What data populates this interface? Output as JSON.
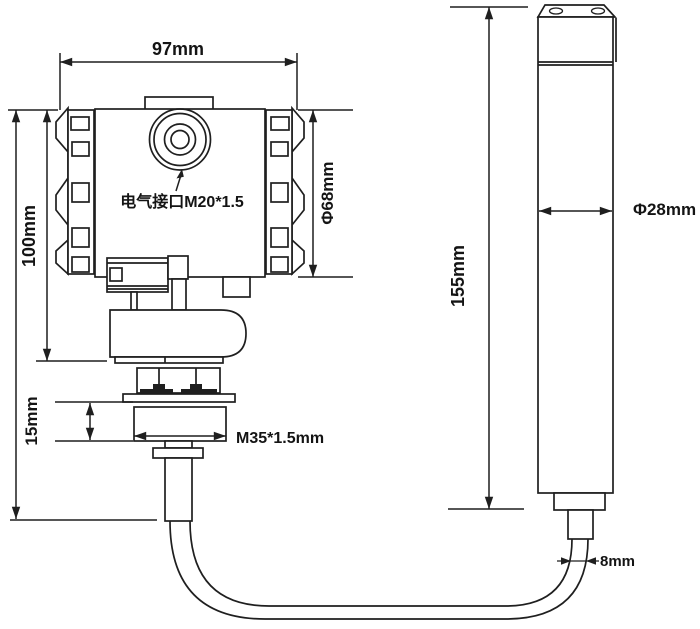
{
  "drawing": {
    "transmitter": {
      "width": "97mm",
      "height": "100mm",
      "housing_diameter": "Φ68mm",
      "electrical_port": "电气接口M20*1.5",
      "thread_height": "15mm",
      "thread_spec": "M35*1.5mm"
    },
    "probe": {
      "length": "155mm",
      "diameter": "Φ28mm",
      "cable_diameter": "8mm"
    },
    "colors": {
      "line": "#1f1f1f",
      "background": "#ffffff",
      "text": "#141414"
    }
  }
}
